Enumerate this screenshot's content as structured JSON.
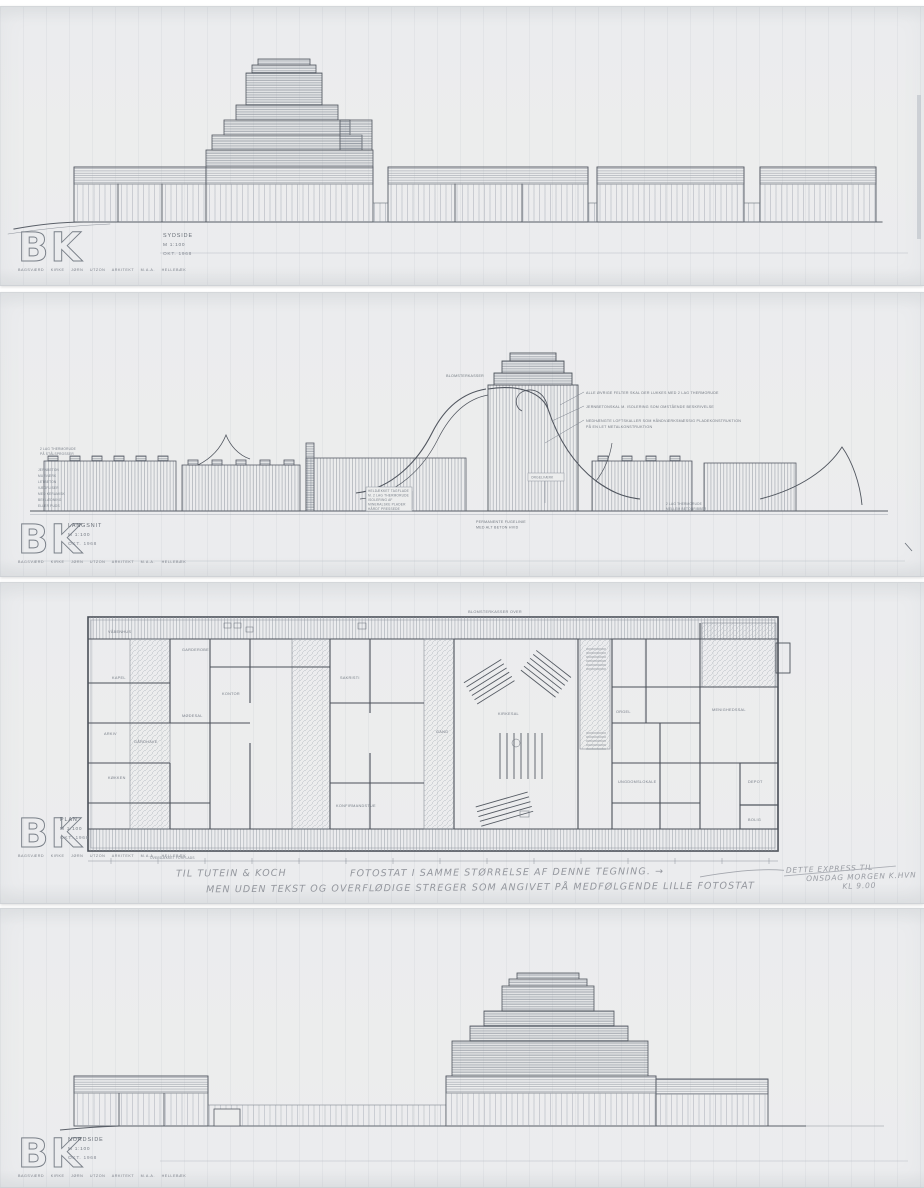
{
  "document": {
    "office_logo": "BK",
    "title_block": {
      "scale": "M 1:100",
      "date": "OKT. 1968",
      "credit": "BAGSVÆRD KIRKE JØRN UTZON ARKITEKT M.A.A. HELLEBÆK"
    },
    "sheets": {
      "sydside": {
        "name": "SYDSIDE"
      },
      "langsnit": {
        "name": "LANGSNIT",
        "labels": {
          "blomsterkasser": "BLOMSTERKASSER",
          "orgel": "ORGELVÆRK",
          "notes_right": [
            "ALLE ØVRIGE FELTER SKAL DER LUKKES MED 2 LAG THERMORUDE",
            "JERNBETONSKAL M. ISOLERING SOM OMSTÅENDE BESKRIVELSE",
            "NEDHÆNGTE LOFTSKALLER SOM HÅNDVÆRKSMÆSSIG PLADEKONSTRUKTION",
            "PÅ EN LET METALKONSTRUKTION"
          ],
          "notes_left_top": [
            "2 LAG THERMORUDE",
            "PÅ STÅLSPROSSER"
          ],
          "notes_left_list": [
            "JERNBETON",
            "MURVÆRK",
            "LETBETON",
            "VÆGFLISER",
            "MED KERAMISK",
            "BEKLÆDNING",
            "ELLER PUDS"
          ],
          "notes_mid": [
            "HELDÆKKET TAGFLADE",
            "M. 2 LAG THERMORUDE",
            "ISOLERING AF",
            "MINERALSKE PLADER",
            "HÅRDT PRESSEDE"
          ],
          "fuge": [
            "PERMANENTE FUGELINIE",
            "MED ALT BETON HVID"
          ],
          "thermo_right": [
            "2 LAG THERMORUDE",
            "MELLEM BETONRIBBER"
          ]
        }
      },
      "plan": {
        "name": "PLAN",
        "labels": {
          "top": "BLOMSTERKASSER OVER",
          "bottom": "OVERDÆKKET FORPLADS",
          "rooms": [
            "VÅBENHUS",
            "GARDEROBE",
            "KAPEL",
            "KONTOR",
            "MØDESAL",
            "ARKIV",
            "KØKKEN",
            "GÅRDHAVE",
            "SAKRISTI",
            "KIRKESAL",
            "ORGEL",
            "GANG",
            "MENIGHEDSSAL",
            "UNGDOMSLOKALE",
            "KONFIRMANDSTUE",
            "DEPOT",
            "BOLIG"
          ]
        }
      },
      "nordside": {
        "name": "NORDSIDE"
      }
    },
    "handwriting": {
      "line1": "TIL  TUTEIN  &  KOCH",
      "line2": "FOTOSTAT  I SAMME  STØRRELSE  AF DENNE  TEGNING.  →",
      "line3": "MEN  UDEN  TEKST  OG  OVERFLØDIGE  STREGER  SOM  ANGIVET  PÅ  MEDFØLGENDE  LILLE  FOTOSTAT",
      "right1": "DETTE EXPRESS TIL",
      "right2": "ONSDAG MORGEN K.HVN",
      "right3": "KL 9.00"
    }
  }
}
